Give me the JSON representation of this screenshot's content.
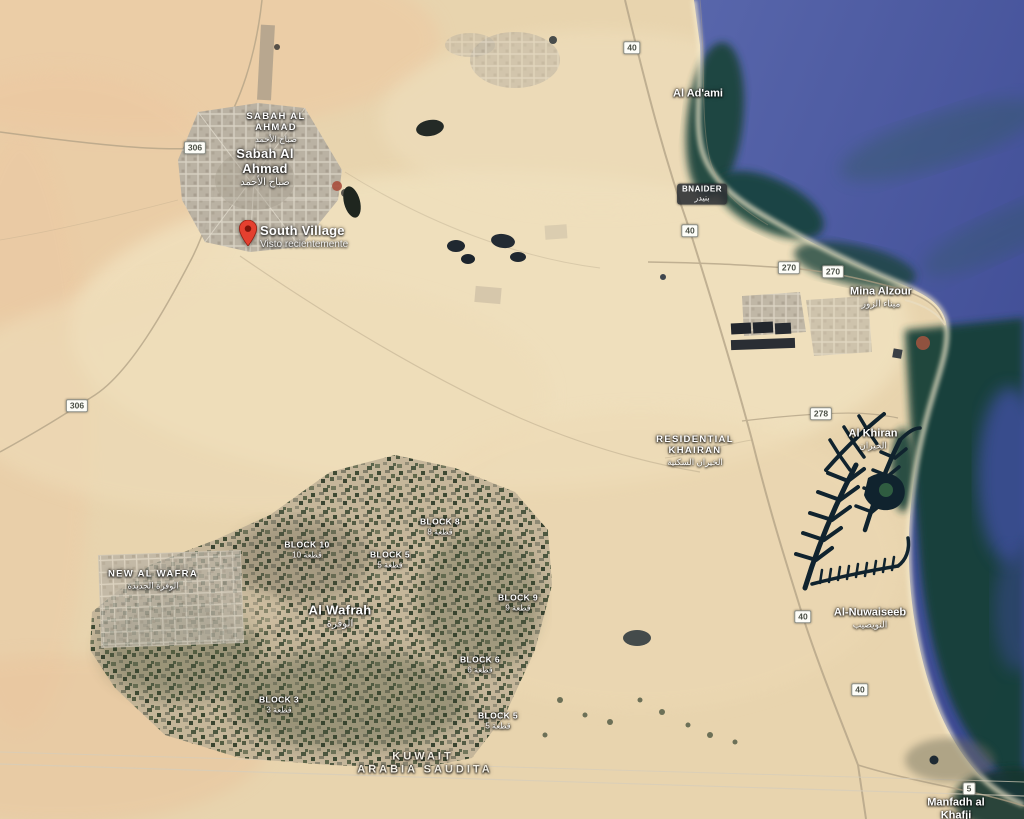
{
  "map": {
    "pin": {
      "label": "South Village",
      "sublabel": "Visto recientemente",
      "x": 248,
      "y": 246,
      "color": "#E4402F"
    },
    "labels": [
      {
        "type": "district",
        "text": "SABAH AL AHMAD",
        "ar": "صباح الأحمد",
        "x": 276,
        "y": 128,
        "w": 72
      },
      {
        "type": "city",
        "text": "Sabah Al Ahmad",
        "ar": "صباح الأحمد",
        "x": 265,
        "y": 168,
        "w": 64
      },
      {
        "type": "place",
        "text": "Al Ad'ami",
        "x": 698,
        "y": 94
      },
      {
        "type": "badge",
        "text": "BNAIDER",
        "ar": "بنيدر",
        "x": 702,
        "y": 194
      },
      {
        "type": "place",
        "text": "Mina Alzour",
        "ar": "ميناء الزور",
        "x": 881,
        "y": 297
      },
      {
        "type": "district",
        "text": "RESIDENTIAL KHAIRAN",
        "ar": "الخيران السكنية",
        "x": 695,
        "y": 451,
        "w": 86
      },
      {
        "type": "place",
        "text": "Al Khiran",
        "ar": "الخيران",
        "x": 873,
        "y": 439
      },
      {
        "type": "place",
        "text": "Al-Nuwaiseeb",
        "ar": "النويصيب",
        "x": 870,
        "y": 618
      },
      {
        "type": "district",
        "text": "NEW AL WAFRA",
        "ar": "الوفرة الجديدة",
        "x": 153,
        "y": 580,
        "w": 94
      },
      {
        "type": "city",
        "text": "Al Wafrah",
        "ar": "الوفرة",
        "x": 340,
        "y": 617
      },
      {
        "type": "block",
        "text": "BLOCK 8",
        "ar": "قطعة 8",
        "x": 440,
        "y": 527
      },
      {
        "type": "block",
        "text": "BLOCK 10",
        "ar": "قطعة 10",
        "x": 307,
        "y": 550
      },
      {
        "type": "block",
        "text": "BLOCK 5",
        "ar": "قطعة 5",
        "x": 390,
        "y": 560
      },
      {
        "type": "block",
        "text": "BLOCK 9",
        "ar": "قطعة 9",
        "x": 518,
        "y": 603
      },
      {
        "type": "block",
        "text": "BLOCK 6",
        "ar": "قطعة 6",
        "x": 480,
        "y": 665
      },
      {
        "type": "block",
        "text": "BLOCK 3",
        "ar": "قطعة 3",
        "x": 279,
        "y": 705
      },
      {
        "type": "block",
        "text": "BLOCK 5",
        "ar": "قطعة 5",
        "x": 498,
        "y": 721
      },
      {
        "type": "border",
        "text": "KUWAIT",
        "x": 423,
        "y": 757
      },
      {
        "type": "border",
        "text": "ARABIA SAUDITA",
        "x": 425,
        "y": 770
      },
      {
        "type": "place",
        "text": "Manfadh al Khafji",
        "x": 956,
        "y": 809,
        "w": 66
      }
    ],
    "shields": [
      {
        "num": "306",
        "x": 195,
        "y": 148
      },
      {
        "num": "306",
        "x": 77,
        "y": 406
      },
      {
        "num": "40",
        "x": 632,
        "y": 48
      },
      {
        "num": "40",
        "x": 690,
        "y": 231
      },
      {
        "num": "270",
        "x": 789,
        "y": 268
      },
      {
        "num": "270",
        "x": 833,
        "y": 272
      },
      {
        "num": "278",
        "x": 821,
        "y": 414
      },
      {
        "num": "40",
        "x": 803,
        "y": 617
      },
      {
        "num": "40",
        "x": 860,
        "y": 690
      },
      {
        "num": "5",
        "x": 969,
        "y": 789
      }
    ],
    "colors": {
      "sand": "#e8d4ae",
      "sea_deep": "#3f4c96",
      "sea_shallow": "#173f38",
      "urban": "#b7b0a2",
      "farm": "#c3b499",
      "pin_red": "#E4402F",
      "shield_bg": "#fdfdf8",
      "label_text": "#ffffff"
    }
  }
}
